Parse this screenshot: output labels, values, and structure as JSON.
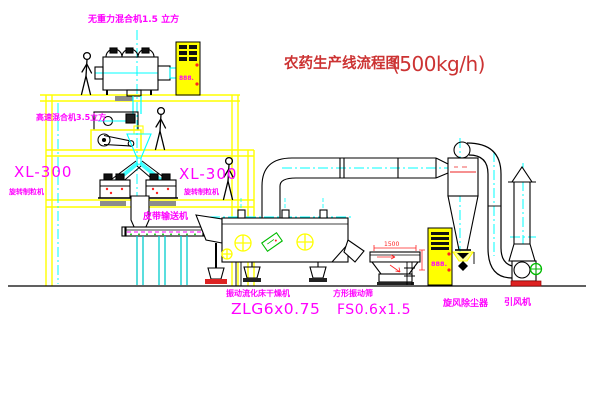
{
  "title": {
    "zh": "农药生产线流程图",
    "capacity": "(500kg/h)"
  },
  "labels": {
    "top_mixer": "无重力混合机1.5 立方",
    "high_speed_mixer": "高速混合机3.5立方",
    "xl300_left": "XL-300",
    "granulator_left": "旋转制粒机",
    "xl300_right": "XL-300",
    "granulator_right": "旋转制粒机",
    "belt_conveyor": "皮带输送机",
    "dryer_name": "振动流化床干燥机",
    "dryer_model": "ZLG6x0.75",
    "screen_name": "方形振动筛",
    "screen_model": "FS0.6x1.5",
    "cyclone": "旋风除尘器",
    "fan": "引风机",
    "screen_dim": "1500",
    "cabinet_display_top": "888.",
    "cabinet_display_right": "888."
  },
  "colors": {
    "structure": "#ffff00",
    "centerline": "#00ffff",
    "label": "#ff00ff",
    "title": "#cc3333",
    "dimension": "#ff2222",
    "motor": "#00bb00"
  }
}
